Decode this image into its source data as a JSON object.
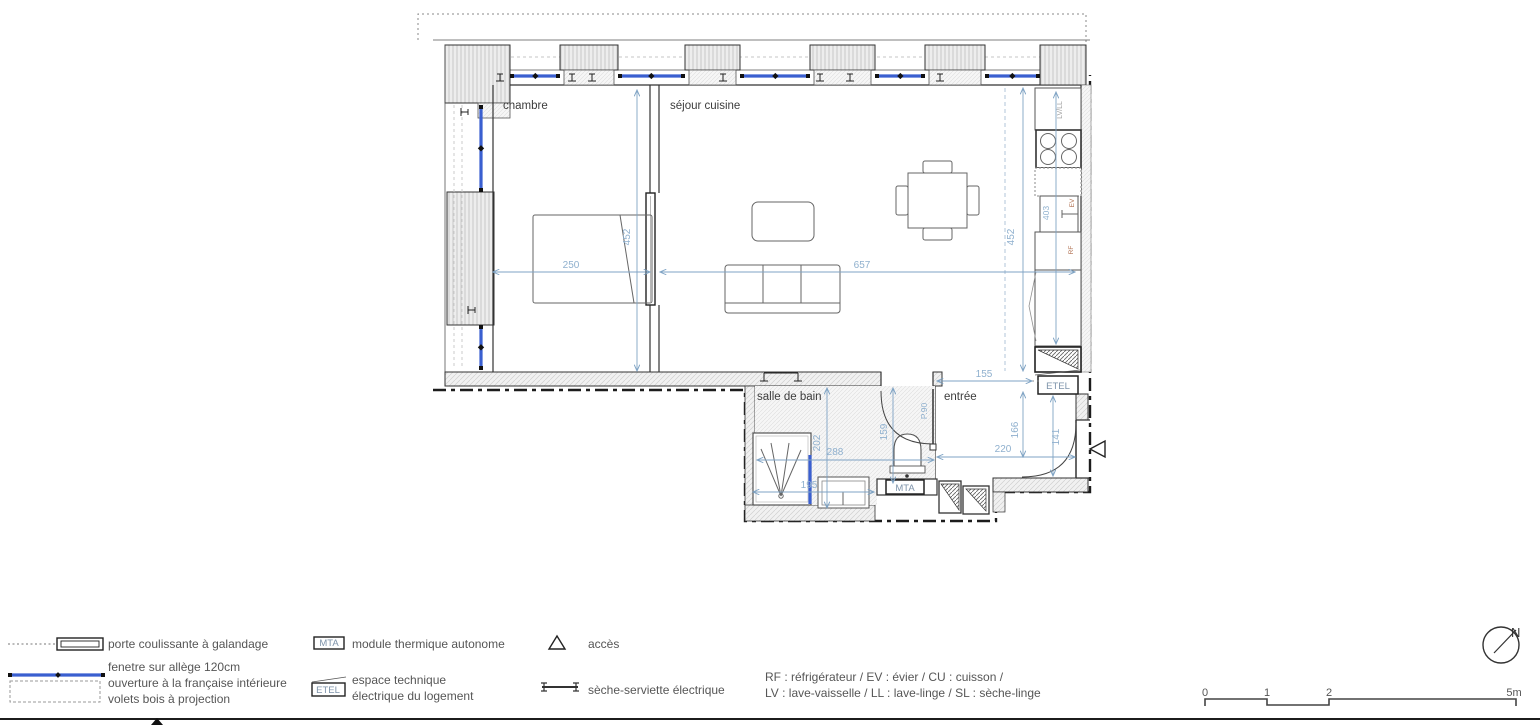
{
  "plan": {
    "room_labels": {
      "chambre": "chambre",
      "sejour": "séjour cuisine",
      "sdb": "salle de bain",
      "entree": "entrée"
    },
    "dims": {
      "d250": "250",
      "d657": "657",
      "d452_left": "452",
      "d452_right": "452",
      "d403": "403",
      "d155": "155",
      "d166": "166",
      "d220": "220",
      "d141": "141",
      "d288": "288",
      "d202": "202",
      "d159": "159",
      "d195": "195",
      "p90": "P.90"
    },
    "tags": {
      "etel": "ETEL",
      "mta": "MTA",
      "lvll": "LV/LL",
      "rf": "RF",
      "ev": "EV"
    }
  },
  "legend": {
    "sliding_door": "porte coulissante à galandage",
    "window_l1": "fenetre sur allège 120cm",
    "window_l2": "ouverture à la française intérieure",
    "window_l3": "volets bois à projection",
    "mta_tag": "MTA",
    "mta_label": "module thermique autonome",
    "etel_tag": "ETEL",
    "etel_l1": "espace technique",
    "etel_l2": "électrique du logement",
    "acces": "accès",
    "seche": "sèche-serviette électrique",
    "abbrev_l1": "RF : réfrigérateur / EV : évier / CU : cuisson /",
    "abbrev_l2": "LV : lave-vaisselle / LL : lave-linge / SL : sèche-linge"
  },
  "scalebar": {
    "t0": "0",
    "t1": "1",
    "t2": "2",
    "t5": "5m"
  },
  "north_label": "N",
  "colors": {
    "window_blue": "#3a5fd0",
    "dimension_blue": "#8fb0ce",
    "wall_dark": "#333333",
    "boundary_black": "#1c1c1c"
  }
}
